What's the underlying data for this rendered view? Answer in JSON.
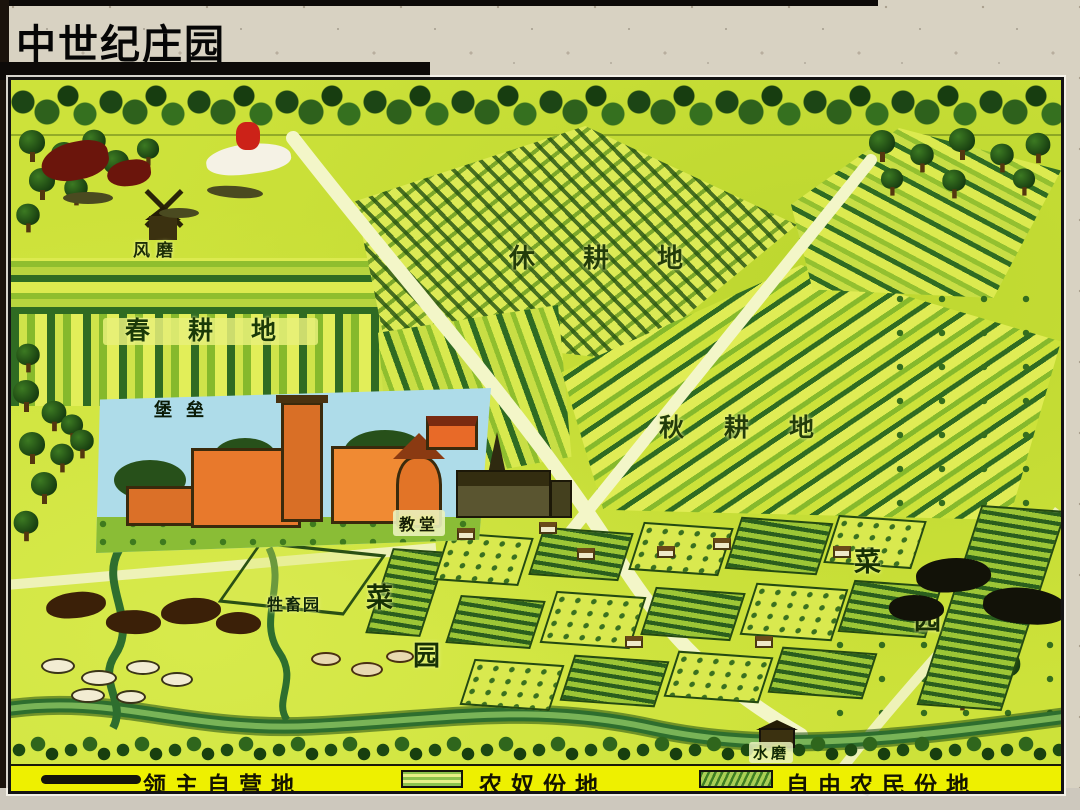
{
  "slide": {
    "title": "中世纪庄园"
  },
  "map": {
    "labels": {
      "windmill": "风磨",
      "spring_field": "春耕地",
      "fallow_field": "休耕地",
      "autumn_field": "秋耕地",
      "castle": "堡垒",
      "church": "教堂",
      "livestock_pen": "牲畜园",
      "water_mill": "水磨",
      "veg_left_top": "菜",
      "veg_left_bottom": "园",
      "veg_right_top": "菜",
      "veg_right_bottom": "园"
    },
    "legend": [
      {
        "label": "领主自营地",
        "symbol": "dark-bar"
      },
      {
        "label": "农奴份地",
        "symbol": "horizontal-stripes"
      },
      {
        "label": "自由农民份地",
        "symbol": "diagonal-stripes"
      }
    ],
    "colors": {
      "meadow": "#cde23a",
      "field_dark_green": "#2f6b22",
      "castle_orange": "#e8792c",
      "panel_sky": "#aedce9",
      "legend_bg": "#eef000",
      "slide_bg": "#d8d2c2",
      "title_color": "#060606"
    }
  }
}
